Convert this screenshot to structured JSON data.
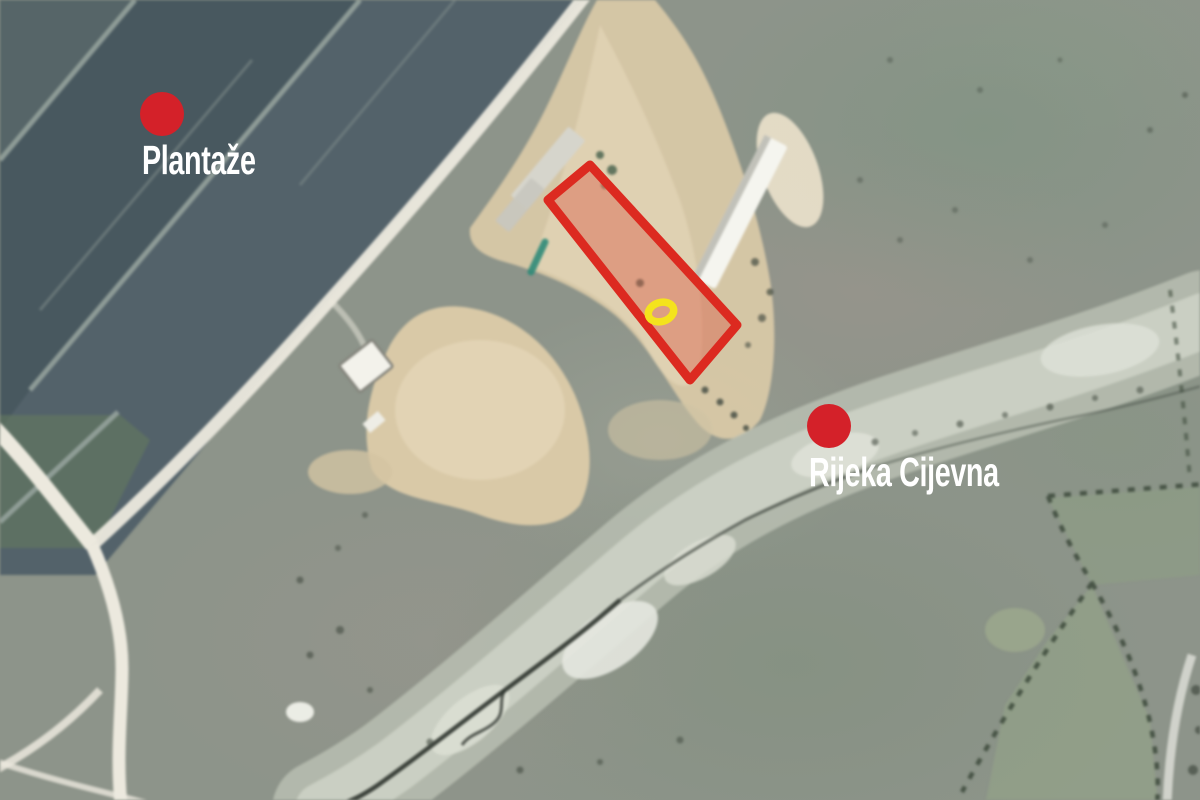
{
  "map": {
    "type": "annotated satellite image",
    "location_context": "aerial view with vineyard fields, dirt lots, buildings, roads and a dry riverbed"
  },
  "markers": [
    {
      "id": "plantaze",
      "label": "Plantaže",
      "x": 162,
      "y": 114,
      "dot_color": "#d42129",
      "label_color": "#ffffff"
    },
    {
      "id": "rijeka-cijevna",
      "label": "Rijeka Cijevna",
      "x": 829,
      "y": 426,
      "dot_color": "#d42129",
      "label_color": "#ffffff"
    }
  ],
  "parcel": {
    "description": "highlighted land parcel outline",
    "outline_color": "#dc2a20",
    "fill_color": "rgba(220,88,66,0.42)",
    "inner_marker_color": "#f4e31d"
  },
  "colors": {
    "accent_red": "#d42129",
    "vineyard_field": "#4e5d63",
    "field_boundary": "#95a29c",
    "dirt": "#d9c9a7",
    "grass": "#8d948a",
    "riverbed_light": "#cdd1c5",
    "river_channel": "#2e342e",
    "road": "#ece9de",
    "building_roof": "#f5f5ef"
  }
}
